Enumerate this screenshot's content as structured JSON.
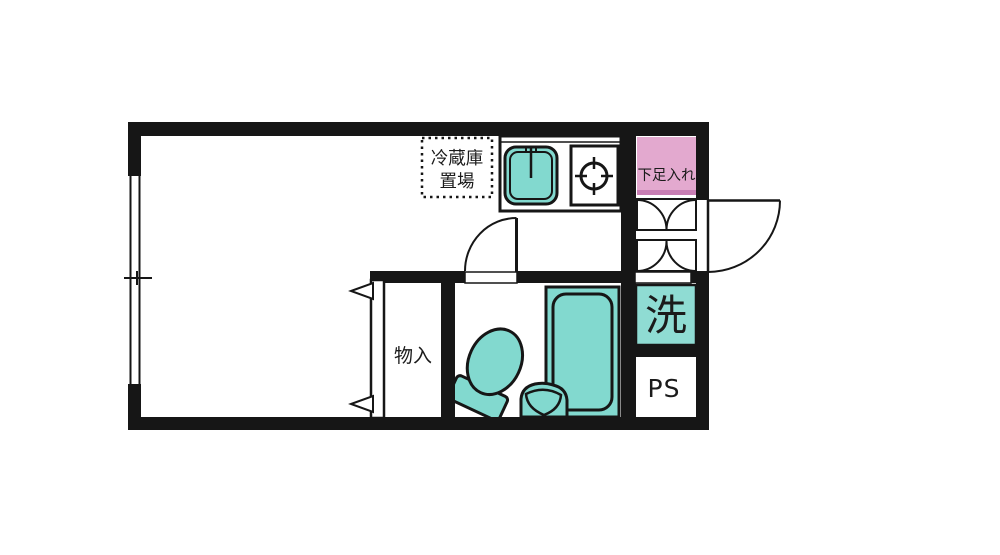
{
  "plan": {
    "type": "apartment-floor-plan",
    "labels": {
      "refrigerator_space_line1": "冷蔵庫",
      "refrigerator_space_line2": "置場",
      "shoe_storage": "下足入れ",
      "closet": "物入",
      "washing_machine": "洗",
      "pipe_space": "PS"
    },
    "colors": {
      "fixture_teal": "#82d9cf",
      "washer_teal": "#8fdcd3",
      "shoe_box_pink": "#e3a9cf",
      "shoe_box_pink_accent": "#c87eb4",
      "line_black": "#161616",
      "background": "#ffffff"
    },
    "rooms": [
      {
        "name": "living-room"
      },
      {
        "name": "kitchen"
      },
      {
        "name": "unit-bathroom"
      },
      {
        "name": "closet"
      },
      {
        "name": "entrance"
      },
      {
        "name": "pipe-space"
      }
    ]
  }
}
